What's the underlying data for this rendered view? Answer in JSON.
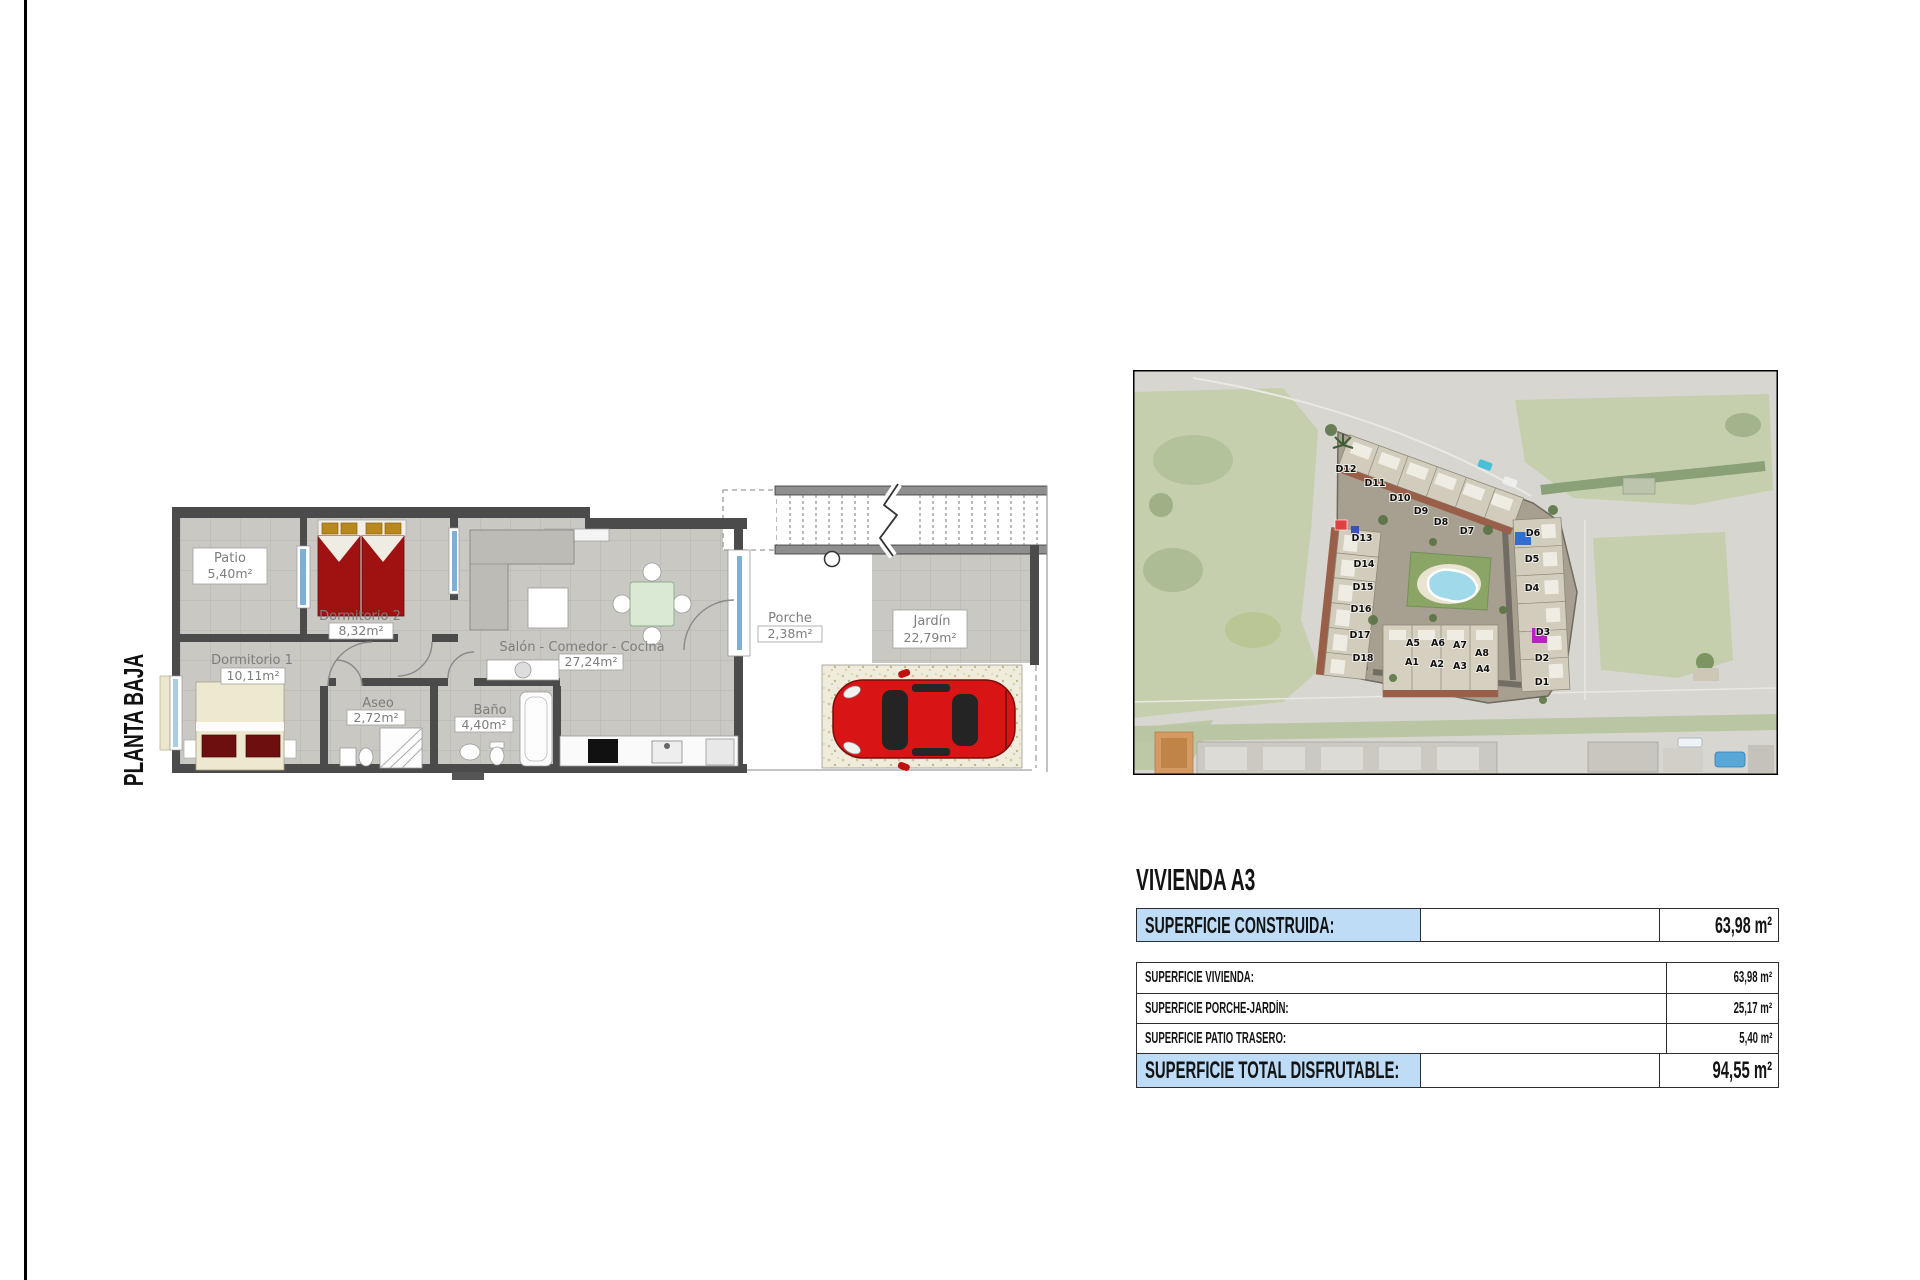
{
  "page": {
    "side_title": "PLANTA BAJA"
  },
  "floor_plan": {
    "rooms": [
      {
        "name": "Patio",
        "area": "5,40m²"
      },
      {
        "name": "Dormitorio 2",
        "area": "8,32m²"
      },
      {
        "name": "Dormitorio 1",
        "area": "10,11m²"
      },
      {
        "name": "Aseo",
        "area": "2,72m²"
      },
      {
        "name": "Baño",
        "area": "4,40m²"
      },
      {
        "name": "Salón - Comedor - Cocina",
        "area": "27,24m²"
      },
      {
        "name": "Porche",
        "area": "2,38m²"
      },
      {
        "name": "Jardín",
        "area": "22,79m²"
      }
    ]
  },
  "site_map": {
    "labels": [
      "D12",
      "D11",
      "D10",
      "D9",
      "D8",
      "D7",
      "D13",
      "D14",
      "D15",
      "D16",
      "D17",
      "D18",
      "D6",
      "D5",
      "D4",
      "D3",
      "D2",
      "D1",
      "A5",
      "A6",
      "A7",
      "A8",
      "A1",
      "A2",
      "A3",
      "A4"
    ]
  },
  "summary": {
    "title": "VIVIENDA A3",
    "construida": {
      "label": "SUPERFICIE CONSTRUIDA:",
      "value": "63,98 m²"
    },
    "rows": [
      {
        "label": "SUPERFICIE VIVIENDA:",
        "value": "63,98 m²"
      },
      {
        "label": "SUPERFICIE PORCHE-JARDÍN:",
        "value": "25,17 m²"
      },
      {
        "label": "SUPERFICIE PATIO TRASERO:",
        "value": "5,40 m²"
      }
    ],
    "total": {
      "label": "SUPERFICIE TOTAL DISFRUTABLE:",
      "value": "94,55 m²"
    }
  },
  "colors": {
    "highlight_blue": "#bedcf5",
    "wall_gray": "#4b4b4b",
    "bed_red": "#a01212",
    "car_red": "#d81414",
    "pool_blue": "#9fd9ea",
    "grass_green": "#c5cfad"
  }
}
